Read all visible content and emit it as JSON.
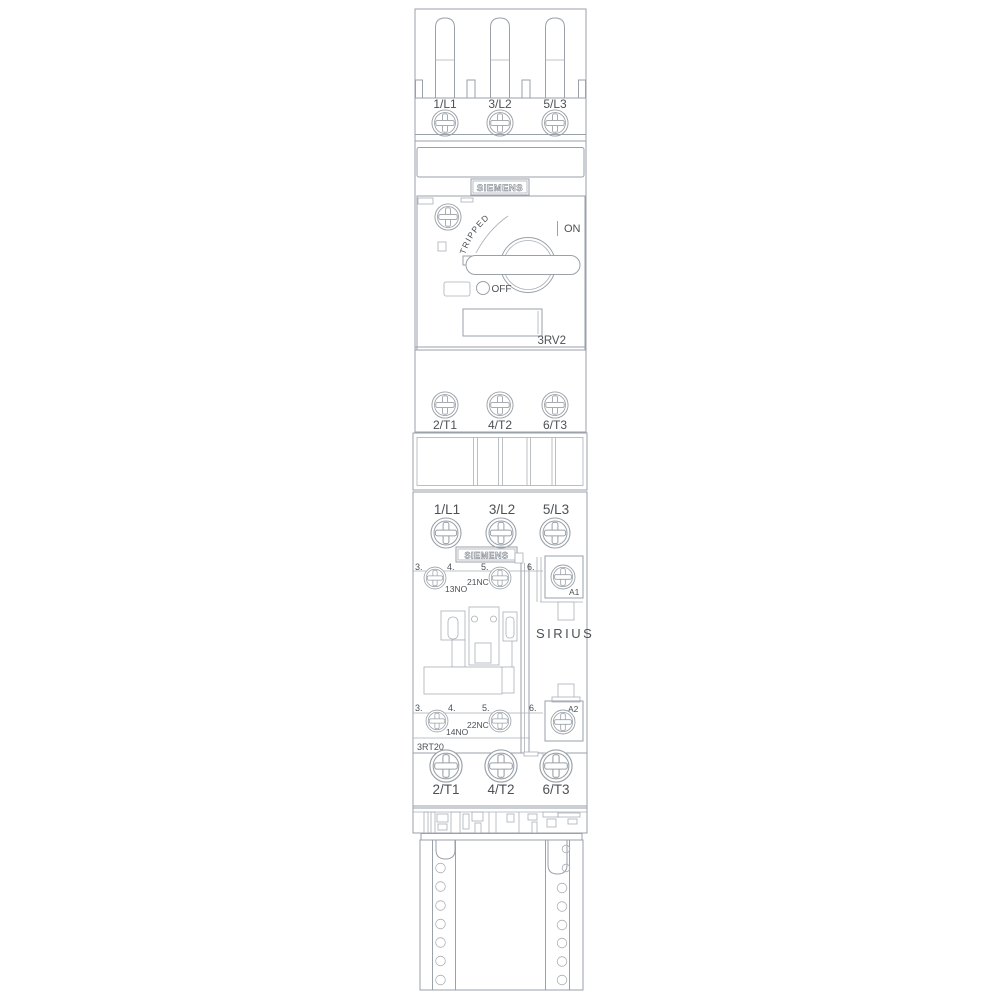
{
  "drawing": {
    "brand": "SIEMENS",
    "series_label": "SIRIUS",
    "colors": {
      "line": "#9aa1a8",
      "text": "#4c5156"
    },
    "breaker": {
      "model": "3RV2",
      "tripped_label": "TRIPPED",
      "on_label": "ON",
      "off_label": "OFF",
      "line_terminals": [
        "1/L1",
        "3/L2",
        "5/L3"
      ],
      "load_terminals": [
        "2/T1",
        "4/T2",
        "6/T3"
      ]
    },
    "contactor": {
      "model": "3RT20",
      "line_terminals": [
        "1/L1",
        "3/L2",
        "5/L3"
      ],
      "load_terminals": [
        "2/T1",
        "4/T2",
        "6/T3"
      ],
      "aux_top": {
        "numbers": [
          "3.",
          "4.",
          "5.",
          "6."
        ],
        "no_label": "13NO",
        "nc_label": "21NC",
        "coil_terminal": "A1"
      },
      "aux_bottom": {
        "numbers": [
          "3.",
          "4.",
          "5.",
          "6."
        ],
        "nc_label": "22NC",
        "no_label": "14NO",
        "coil_terminal": "A2"
      }
    }
  }
}
